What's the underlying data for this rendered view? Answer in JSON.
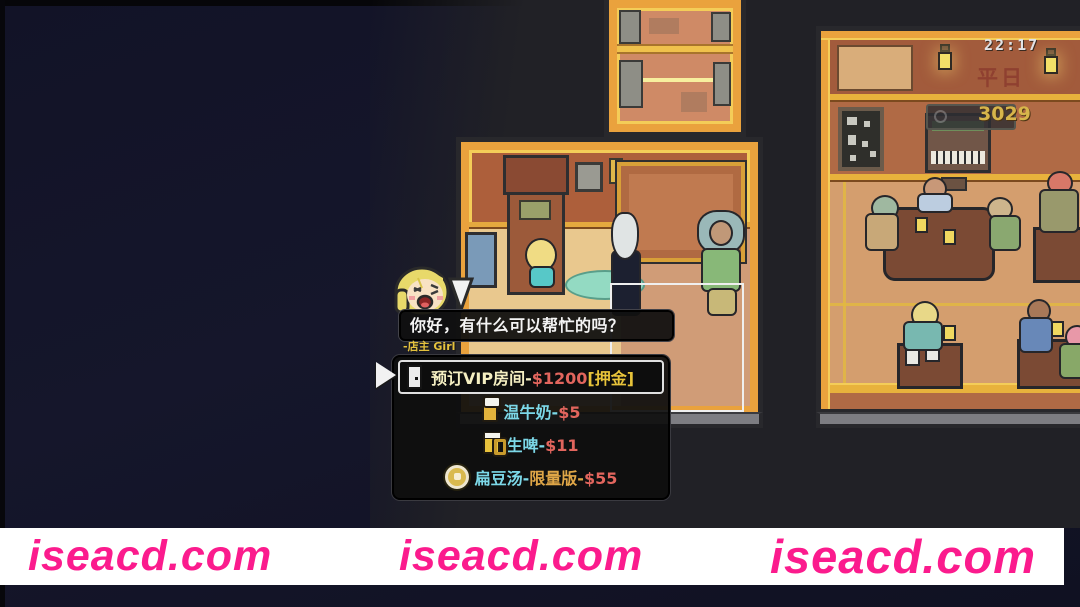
{
  "hud": {
    "time": "22:17",
    "day_label": "平日",
    "money": "3029"
  },
  "dialogue": {
    "speaker_label": "-店主 Girl",
    "text": "你好，有什么可以帮忙的吗？",
    "options": [
      {
        "label": "预订VIP房间-",
        "price": "$1200",
        "suffix": "[押金]",
        "icon": "door-icon",
        "selected": true
      },
      {
        "label": "温牛奶-",
        "price": "$5",
        "icon": "milk-mug-icon",
        "selected": false
      },
      {
        "label": "生啤-",
        "price": "$11",
        "icon": "beer-mug-icon",
        "selected": false
      },
      {
        "label": "扁豆汤-",
        "edition": "限量版-",
        "price": "$55",
        "icon": "soup-coin-icon",
        "selected": false
      }
    ]
  },
  "watermarks": [
    "iseacd.com",
    "iseacd.com",
    "iseacd.com"
  ],
  "colors": {
    "option_label_cyan": "#7cd8e8",
    "option_price_red": "#e2655d",
    "option_suffix_yellow": "#e7c33a",
    "edition_orange": "#dfa647",
    "vip_label_pale": "#f5efc2",
    "money_yellow": "#d7b54b",
    "watermark_pink": "#fb1b8d",
    "speaker_yellow": "#e5c23e",
    "room_gold": "#eaa23d",
    "wall_orange": "#ad5f3b"
  }
}
